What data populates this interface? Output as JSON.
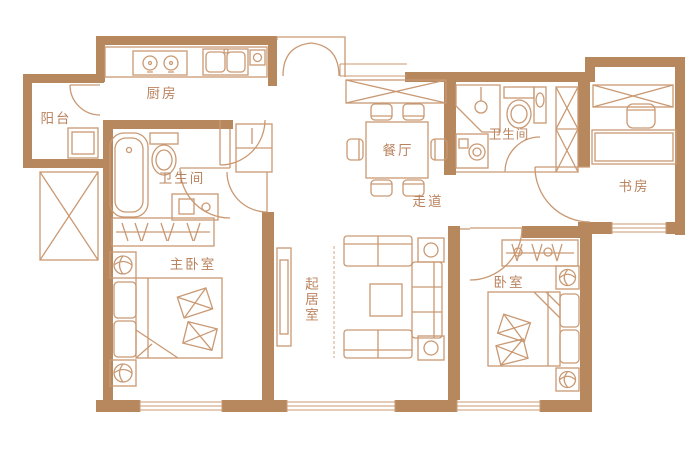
{
  "colors": {
    "wall": "#b7875e",
    "line": "#c99973",
    "lineSoft": "#d9b896",
    "text": "#b9835f",
    "background": "#ffffff"
  },
  "rooms": {
    "balcony": {
      "label": "阳台"
    },
    "kitchen": {
      "label": "厨房"
    },
    "bathroom_main": {
      "label": "卫生间"
    },
    "master_bedroom": {
      "label": "主卧室"
    },
    "living_room": {
      "label": "起居室"
    },
    "dining_room": {
      "label": "餐厅"
    },
    "hallway": {
      "label": "走道"
    },
    "bathroom_guest": {
      "label": "卫生间"
    },
    "study": {
      "label": "书房"
    },
    "bedroom": {
      "label": "卧室"
    }
  }
}
